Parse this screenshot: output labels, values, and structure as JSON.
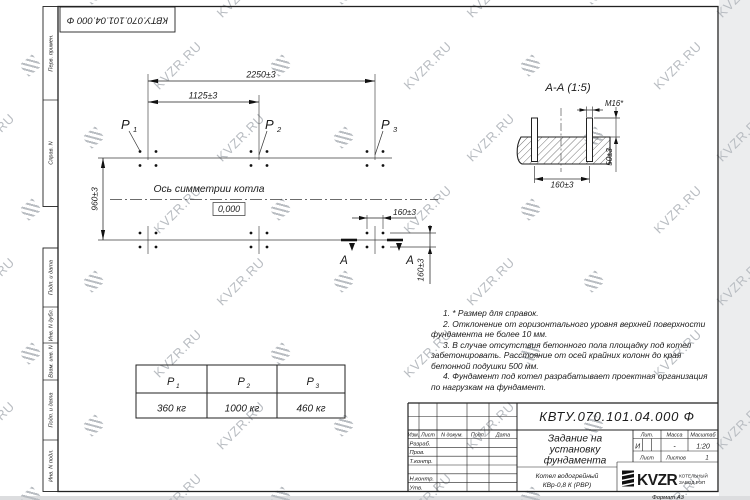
{
  "watermark": {
    "text": "KVZR.RU"
  },
  "doc_number": "КВТУ.070.101.04.000  Ф",
  "margin_columns": {
    "top": [
      "Перв. примен.",
      "Справ. N"
    ],
    "bottom": [
      "Подп. и дата",
      "Инв. N дубл.",
      "Взам. инв. N",
      "Подп. и дата",
      "Инв. N подл."
    ]
  },
  "plan": {
    "dim_width_total": "2250±3",
    "dim_width_half": "1125±3",
    "dim_depth": "960±3",
    "dim_bolt_spacing_h": "160±3",
    "dim_bolt_spacing_v": "160±3",
    "axis_label": "Ось симметрии котла",
    "level_mark": "0,000",
    "section_letter": "А"
  },
  "points": [
    {
      "base": "P",
      "sub": "1",
      "mass": "360 кг"
    },
    {
      "base": "P",
      "sub": "2",
      "mass": "1000 кг"
    },
    {
      "base": "P",
      "sub": "3",
      "mass": "460 кг"
    }
  ],
  "section_view": {
    "title": "А-А (1:5)",
    "bolt_thread": "М16*",
    "dim_protrusion": "50±3",
    "dim_spacing": "160±3"
  },
  "notes": [
    "1. * Размер для справок.",
    "2. Отклонение от горизонтального уровня верхней поверхности фундамента не более 10 мм.",
    "3. В случае отсутствия бетонного пола площадку под котел забетонировать. Расстояние от осей крайних колонн до края бетонной подушки 500 мм.",
    "4. Фундамент под котел разрабатывает проектная организация по нагрузкам на фундамент."
  ],
  "title_block": {
    "title_lines": [
      "Задание на",
      "установку",
      "фундамента"
    ],
    "product_lines": [
      "Котел водогрейный",
      "КВр-0,8 К (РВР)"
    ],
    "header_cells": [
      "Изм.",
      "Лист",
      "N докум.",
      "Подп.",
      "Дата"
    ],
    "row_labels": [
      "Разраб.",
      "Пров.",
      "Т.контр.",
      "Н.контр.",
      "Утв."
    ],
    "lit_label": "Лит.",
    "lit_value": "И",
    "mass_label": "Масса",
    "mass_value": "-",
    "scale_label": "Масштаб",
    "scale_value": "1:20",
    "sheet_label": "Лист",
    "sheets_label": "Листов",
    "sheets_value": "1",
    "company_name": "KVZR",
    "company_line1": "КОТЕЛЬНЫЙ",
    "company_line2": "ЗАВОД РЭП",
    "format_note": "Формат А3"
  }
}
